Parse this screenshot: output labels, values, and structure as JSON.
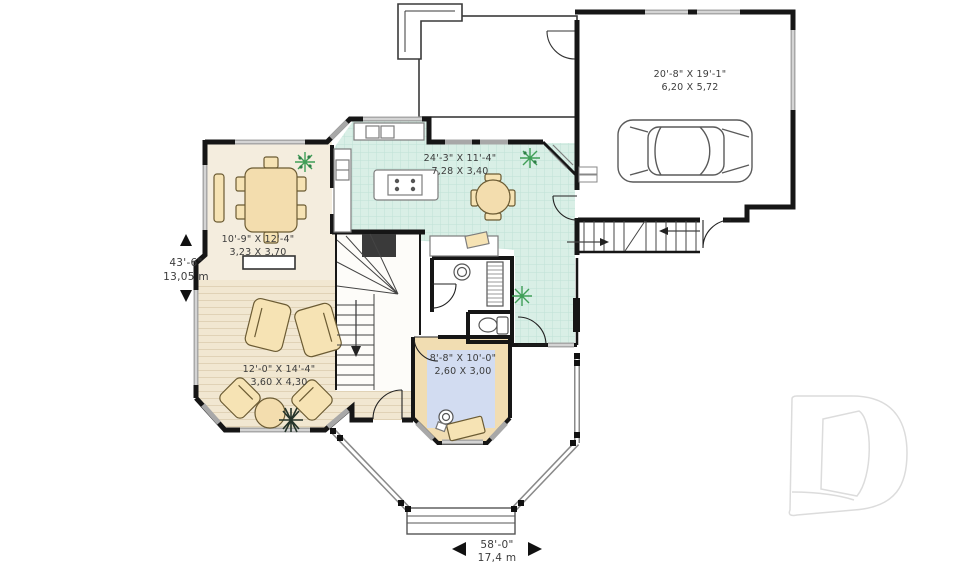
{
  "plan": {
    "title": "first-floor-plan",
    "labels": {
      "garage": {
        "imperial": "20'-8\" X 19'-1\"",
        "metric": "6,20 X 5,72"
      },
      "kitchen": {
        "imperial": "24'-3\" X 11'-4\"",
        "metric": "7,28 X 3,40"
      },
      "dining": {
        "imperial": "10'-9\" X 12'-4\"",
        "metric": "3,23 X 3,70"
      },
      "living": {
        "imperial": "12'-0\" X 14'-4\"",
        "metric": "3,60 X 4,30"
      },
      "den": {
        "imperial": "8'-8\" X 10'-0\"",
        "metric": "2,60 X 3,00"
      }
    },
    "overall": {
      "depth": {
        "imperial": "43'-6\"",
        "metric": "13,05 m"
      },
      "width": {
        "imperial": "58'-0\"",
        "metric": "17,4 m"
      }
    },
    "colors": {
      "wall": "#161616",
      "kitchen_tile": "#d9efe6",
      "kitchen_grid": "#bfe2d6",
      "dining_floor": "#f4edde",
      "living_floor": "#f1e7d1",
      "den_border": "#f1ddb2",
      "den_rug": "#d2dcf1",
      "furniture": "#f6e3b4",
      "window_gray": "#a8a8a8",
      "plant_green": "#3f9e57",
      "logo_outline": "#dcdcdc"
    },
    "logo": "drummond-d-watermark"
  }
}
